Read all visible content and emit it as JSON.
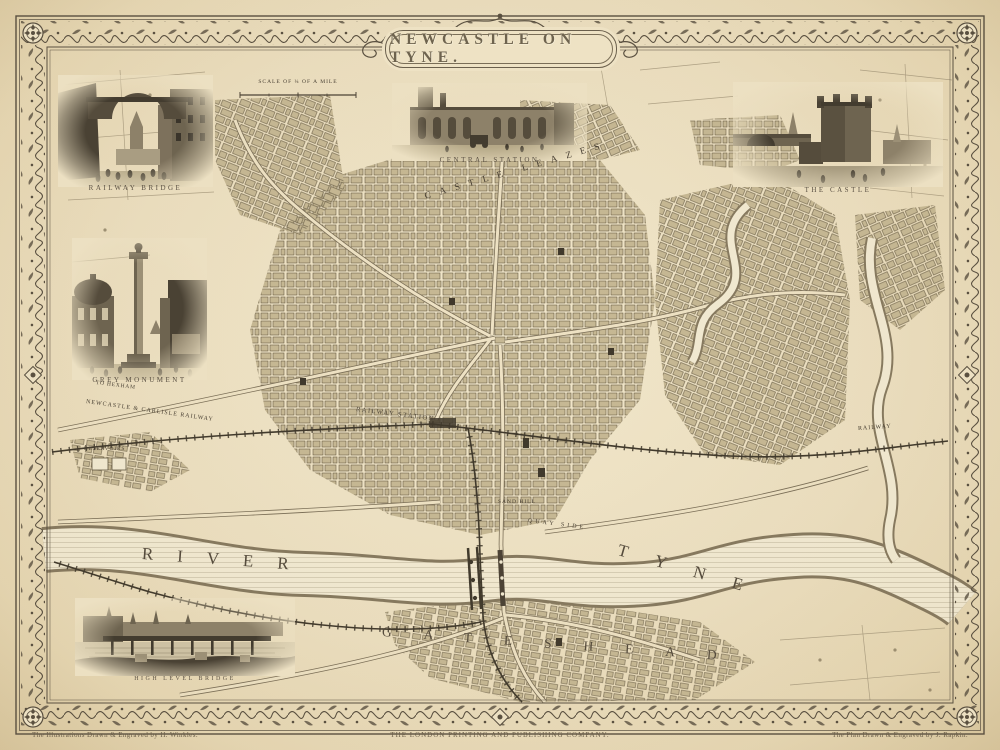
{
  "page": {
    "title": "NEWCASTLE ON TYNE.",
    "paper_color": "#ece0c2",
    "ink_color": "#4a4134",
    "border_color": "#5a5040"
  },
  "scale_bar": {
    "label": "SCALE OF ¼ OF A MILE"
  },
  "vignettes": [
    {
      "id": "railway-bridge",
      "caption": "RAILWAY BRIDGE"
    },
    {
      "id": "grey-monument",
      "caption": "GREY MONUMENT"
    },
    {
      "id": "central-station",
      "caption": "CENTRAL STATION"
    },
    {
      "id": "the-castle",
      "caption": "THE CASTLE"
    },
    {
      "id": "high-level-bridge",
      "caption": "HIGH LEVEL BRIDGE"
    }
  ],
  "map_labels": {
    "castle_leazes": "CASTLE LEAZES",
    "railway_station": "RAILWAY STATION",
    "carlisle_railway": "NEWCASTLE & CARLISLE RAILWAY",
    "to_hexham": "TO HEXHAM",
    "railway_right": "RAILWAY",
    "reservoirs": "RESERVOIRS",
    "river": "RIVER",
    "tyne": "TYNE",
    "gateshead": "GATESHEAD",
    "quay_side": "QUAY SIDE",
    "sand_hill": "SAND HILL"
  },
  "imprints": {
    "left": "The Illustrations Drawn & Engraved by H. Winkles.",
    "center": "THE LONDON PRINTING AND PUBLISHING COMPANY.",
    "right": "The Plan Drawn & Engraved by J. Rapkin."
  }
}
